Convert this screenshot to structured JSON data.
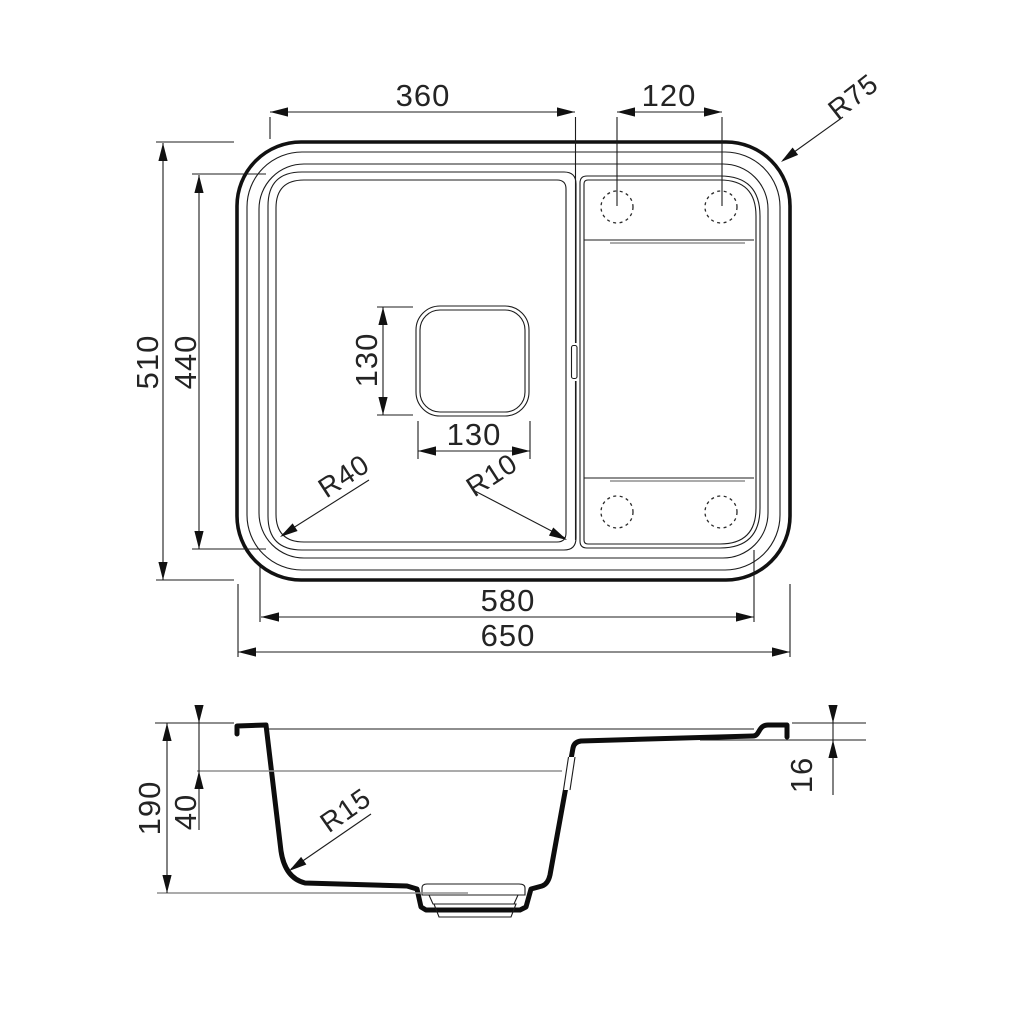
{
  "top_view": {
    "bowl_width": "360",
    "hole_spacing": "120",
    "outer_corner_radius": "R75",
    "overall_depth": "510",
    "bowl_depth": "440",
    "drain_size_vertical": "130",
    "drain_size_horizontal": "130",
    "bowl_corner_radius": "R40",
    "divider_corner_radius": "R10",
    "inner_width": "580",
    "overall_width": "650"
  },
  "section_view": {
    "overall_height": "190",
    "upper_depth": "40",
    "rim_step": "16",
    "bottom_corner_radius": "R15"
  },
  "style": {
    "line_color": "#1c1c1c",
    "reference_color": "#8f8f8f",
    "background_color": "#ffffff"
  }
}
